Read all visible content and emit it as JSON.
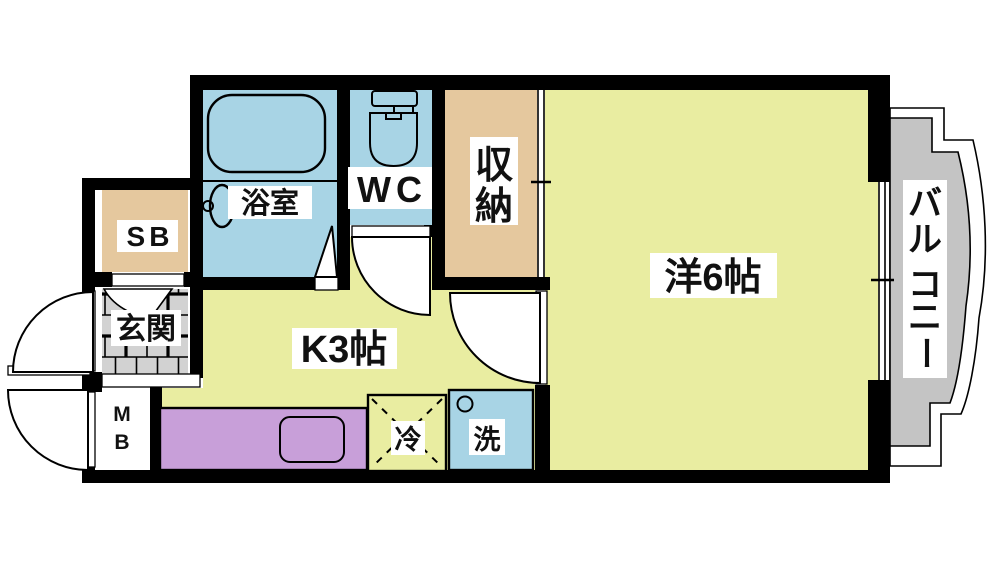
{
  "colors": {
    "floor": "#e9eda1",
    "water": "#a8d4e5",
    "storage": "#e5c89e",
    "counter": "#c89fd9",
    "gray": "#c4c4c4",
    "tile": "#d2d2d2",
    "wall": "#000000",
    "labelbg": "#ffffff",
    "ink": "#111111"
  },
  "rooms": {
    "bathroom": {
      "label": "浴室"
    },
    "toilet": {
      "label": "WC"
    },
    "closet": {
      "chars": [
        "収",
        "納"
      ]
    },
    "western_room": {
      "label": "洋6帖"
    },
    "kitchen": {
      "label": "K3帖"
    },
    "balcony": {
      "chars": [
        "バ",
        "ル",
        "コ",
        "ニ",
        "ー"
      ]
    },
    "shoe_box": {
      "label": "SB"
    },
    "entrance": {
      "label": "玄関"
    },
    "meter_box": {
      "chars": [
        "M",
        "B"
      ]
    },
    "fridge": {
      "label": "冷"
    },
    "washer": {
      "label": "洗"
    }
  }
}
